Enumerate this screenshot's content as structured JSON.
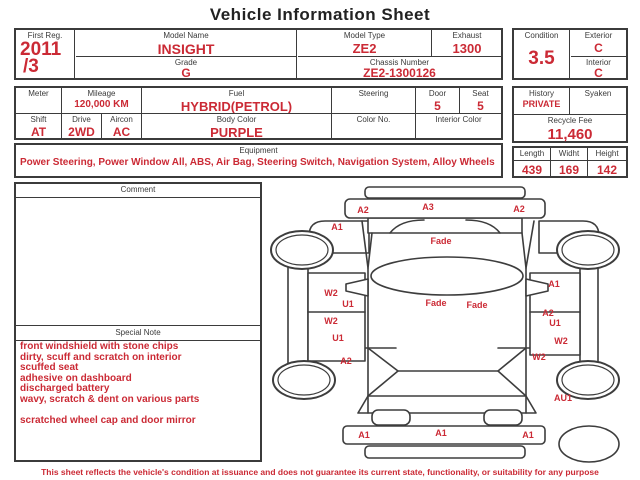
{
  "title": "Vehicle Information Sheet",
  "vehicle": {
    "first_reg": {
      "label": "First Reg.",
      "line1": "2011",
      "line2": "/3"
    },
    "model_name": {
      "label": "Model Name",
      "value": "INSIGHT"
    },
    "model_type": {
      "label": "Model Type",
      "value": "ZE2"
    },
    "exhaust": {
      "label": "Exhaust",
      "value": "1300"
    },
    "grade": {
      "label": "Grade",
      "value": "G"
    },
    "chassis_number": {
      "label": "Chassis Number",
      "value": "ZE2-1300126"
    },
    "condition": {
      "label": "Condition",
      "value": "3.5"
    },
    "exterior": {
      "label": "Exterior",
      "value": "C"
    },
    "interior": {
      "label": "Interior",
      "value": "C"
    },
    "meter": {
      "label": "Meter",
      "value": ""
    },
    "mileage": {
      "label": "Mileage",
      "value": "120,000 KM"
    },
    "fuel": {
      "label": "Fuel",
      "value": "HYBRID(PETROL)"
    },
    "steering": {
      "label": "Steering",
      "value": ""
    },
    "door": {
      "label": "Door",
      "value": "5"
    },
    "seat": {
      "label": "Seat",
      "value": "5"
    },
    "history": {
      "label": "History",
      "value": "PRIVATE"
    },
    "syaken": {
      "label": "Syaken",
      "value": ""
    },
    "shift": {
      "label": "Shift",
      "value": "AT"
    },
    "drive": {
      "label": "Drive",
      "value": "2WD"
    },
    "aircon": {
      "label": "Aircon",
      "value": "AC"
    },
    "body_color": {
      "label": "Body Color",
      "value": "PURPLE"
    },
    "color_no": {
      "label": "Color No.",
      "value": ""
    },
    "interior_color": {
      "label": "Interior Color",
      "value": ""
    },
    "recycle_fee": {
      "label": "Recycle Fee",
      "value": "11,460"
    },
    "equipment": {
      "label": "Equipment",
      "value": "Power Steering, Power Window All, ABS, Air Bag, Steering Switch, Navigation System, Alloy Wheels"
    },
    "dimensions": {
      "length": {
        "label": "Length",
        "value": "439"
      },
      "width": {
        "label": "Widht",
        "value": "169"
      },
      "height": {
        "label": "Height",
        "value": "142"
      }
    }
  },
  "comment": {
    "label": "Comment",
    "value": ""
  },
  "special_note": {
    "label": "Special Note",
    "lines": [
      "front windshield with stone chips",
      "dirty, scuff and scratch on interior",
      "scuffed seat",
      "adhesive on dashboard",
      "discharged battery",
      "wavy, scratch & dent on various parts",
      "",
      "scratched wheel cap and door mirror"
    ]
  },
  "diagram": {
    "marks": [
      {
        "text": "A2",
        "x": 363,
        "y": 210
      },
      {
        "text": "A3",
        "x": 428,
        "y": 207
      },
      {
        "text": "A2",
        "x": 519,
        "y": 209
      },
      {
        "text": "A1",
        "x": 337,
        "y": 227
      },
      {
        "text": "Fade",
        "x": 441,
        "y": 241
      },
      {
        "text": "W2",
        "x": 331,
        "y": 293
      },
      {
        "text": "U1",
        "x": 348,
        "y": 304
      },
      {
        "text": "W2",
        "x": 331,
        "y": 321
      },
      {
        "text": "U1",
        "x": 338,
        "y": 338
      },
      {
        "text": "A2",
        "x": 346,
        "y": 361
      },
      {
        "text": "Fade",
        "x": 436,
        "y": 303
      },
      {
        "text": "Fade",
        "x": 477,
        "y": 305
      },
      {
        "text": "A1",
        "x": 554,
        "y": 284
      },
      {
        "text": "A2",
        "x": 548,
        "y": 313
      },
      {
        "text": "U1",
        "x": 555,
        "y": 323
      },
      {
        "text": "W2",
        "x": 561,
        "y": 341
      },
      {
        "text": "W2",
        "x": 539,
        "y": 357
      },
      {
        "text": "AU1",
        "x": 563,
        "y": 398
      },
      {
        "text": "A1",
        "x": 364,
        "y": 435
      },
      {
        "text": "A1",
        "x": 441,
        "y": 433
      },
      {
        "text": "A1",
        "x": 528,
        "y": 435
      }
    ]
  },
  "disclaimer": "This sheet reflects the vehicle's condition at issuance and does not guarantee its current state, functionality, or suitability for any purpose",
  "colors": {
    "accent_red": "#cb2a35",
    "line": "#3b3b3b"
  }
}
